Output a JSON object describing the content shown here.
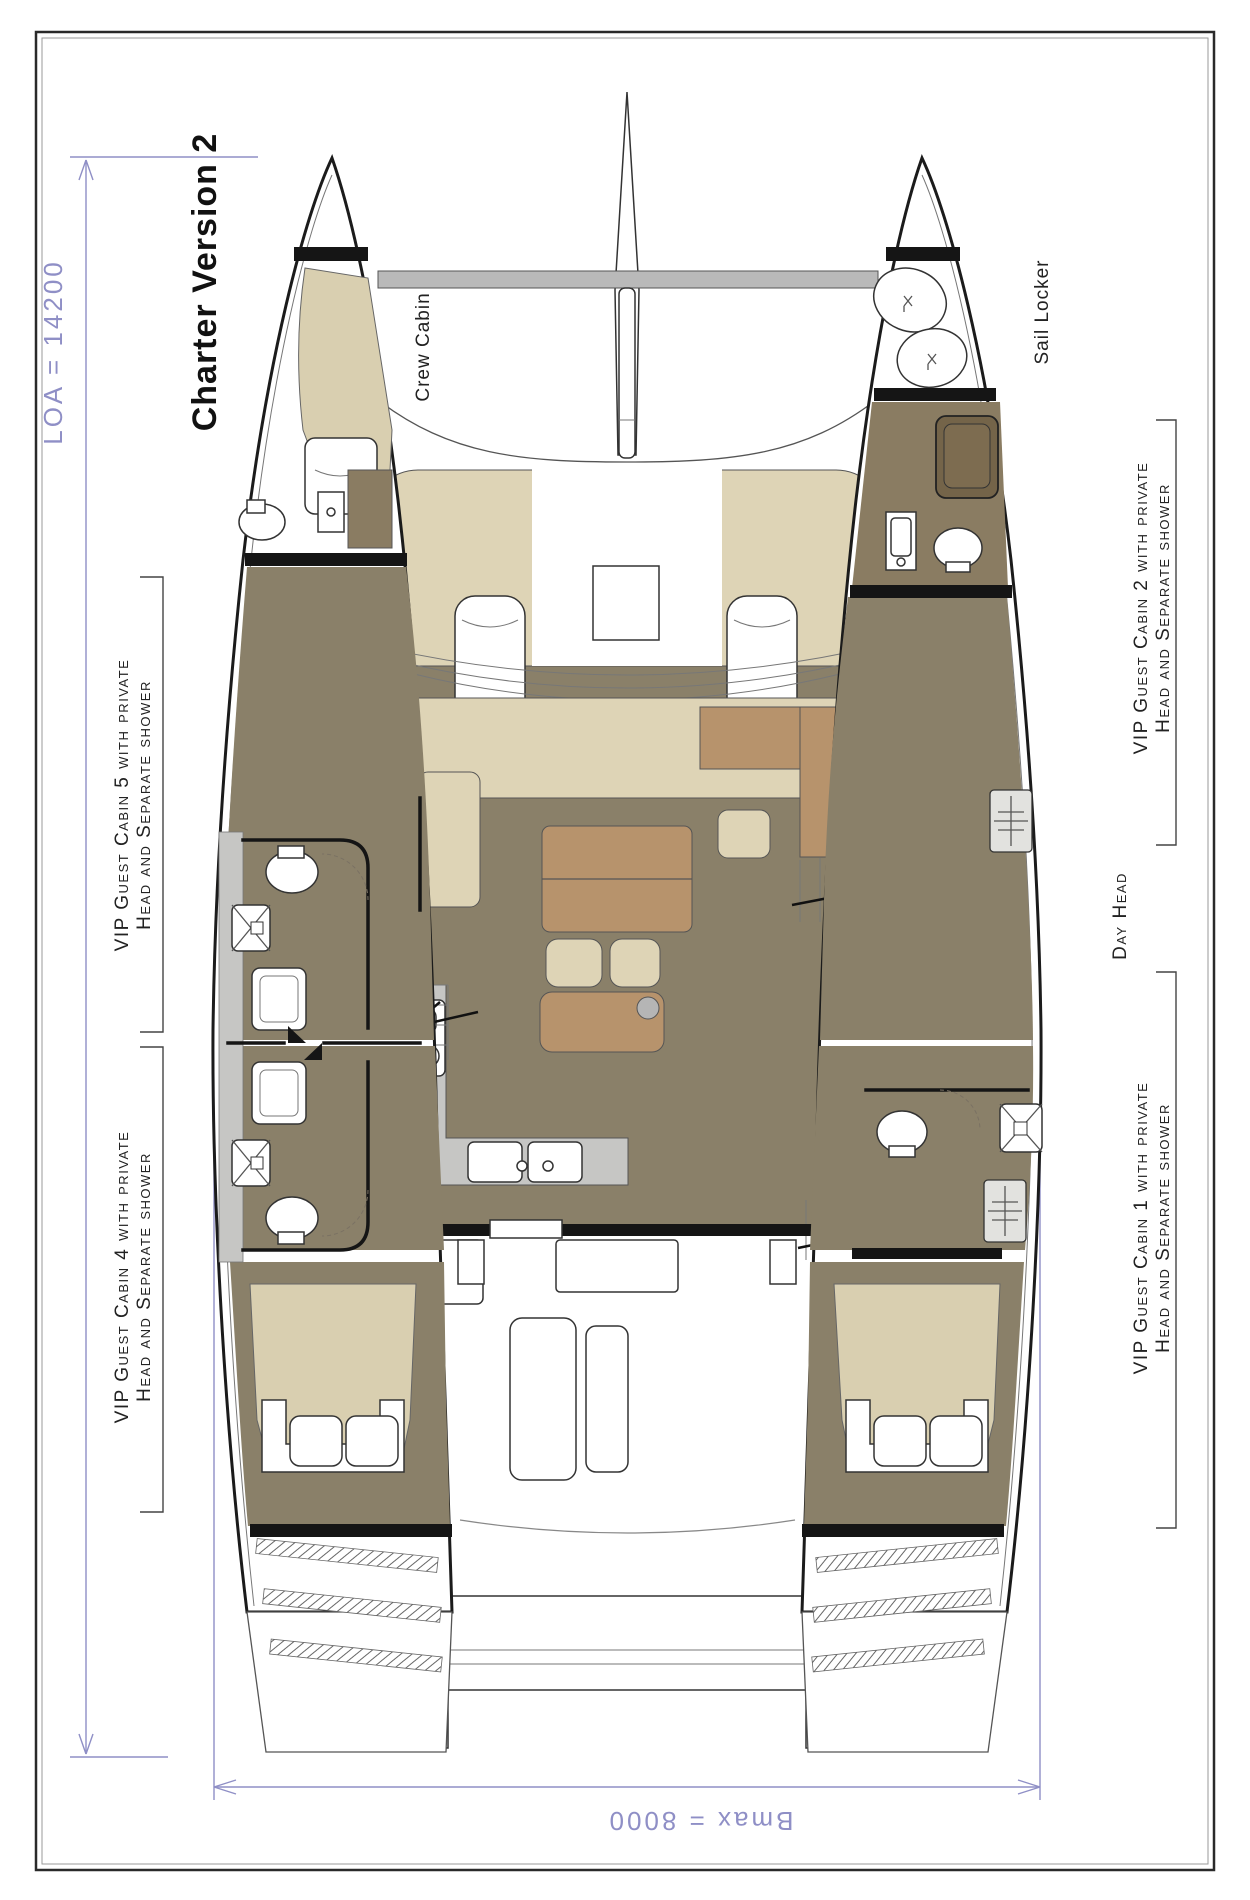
{
  "title": "Charter Version 2",
  "dimensions": {
    "loa": "LOA = 14200",
    "bmax": "Bmax = 8000"
  },
  "rooms": {
    "crew_cabin": "Crew Cabin",
    "sail_locker": "Sail Locker",
    "day_head": "Day Head",
    "service_room": {
      "line1": "Service",
      "line2": "Room"
    }
  },
  "cabins": {
    "cabin5": {
      "line1": "VIP Guest Cabin 5 with private",
      "line2": "Head and Separate shower"
    },
    "cabin4": {
      "line1": "VIP Guest Cabin 4 with private",
      "line2": "Head and Separate shower"
    },
    "cabin2": {
      "line1": "VIP Guest Cabin 2 with private",
      "line2": "Head and Separate shower"
    },
    "cabin1": {
      "line1": "VIP Guest Cabin 1 with private",
      "line2": "Head and Separate shower"
    }
  },
  "colors": {
    "floor": "#8a8069",
    "seat_cream": "#ded4b6",
    "bed_tan": "#d9cfb0",
    "table_brown": "#b7936c",
    "wood_light": "#a08b6c",
    "wood_dark": "#8a7c62",
    "counter_gray": "#c6c6c4",
    "beam_gray": "#b9b9b9",
    "wall_black": "#151515",
    "dimension_purple": "#8f8fc6"
  }
}
